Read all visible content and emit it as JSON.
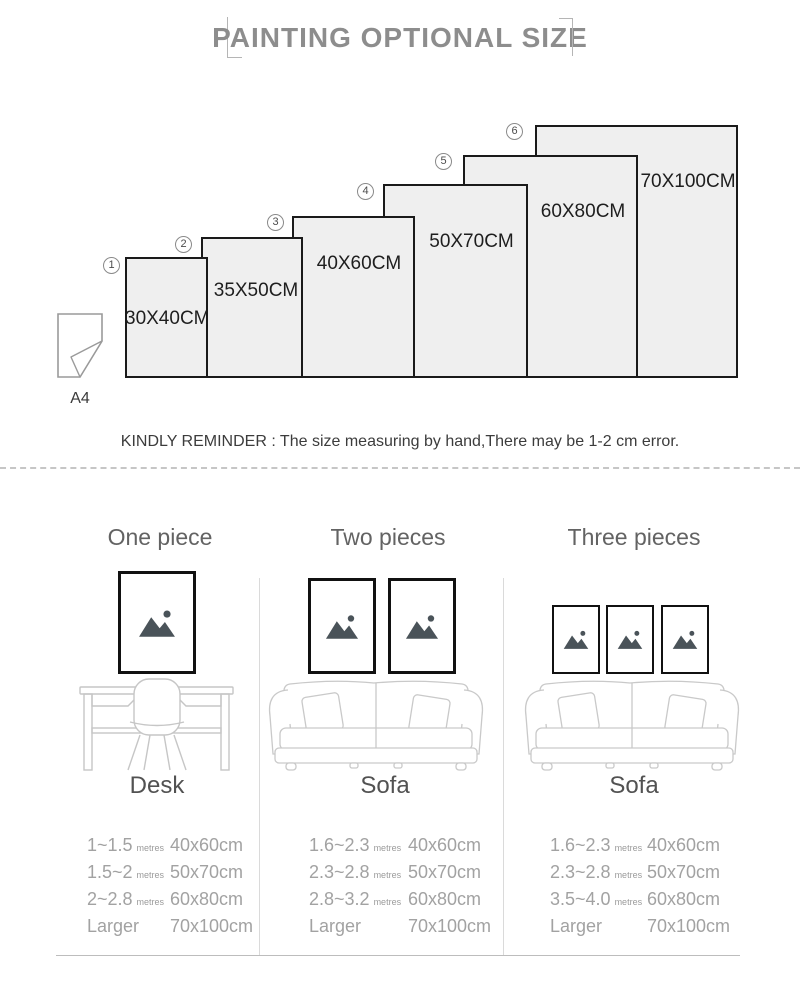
{
  "header": {
    "title": "PAINTING OPTIONAL SIZE"
  },
  "size_chart": {
    "a4_label": "A4",
    "items": [
      {
        "num": "1",
        "label": "30X40CM"
      },
      {
        "num": "2",
        "label": "35X50CM"
      },
      {
        "num": "3",
        "label": "40X60CM"
      },
      {
        "num": "4",
        "label": "50X70CM"
      },
      {
        "num": "5",
        "label": "60X80CM"
      },
      {
        "num": "6",
        "label": "70X100CM"
      }
    ]
  },
  "reminder": "KINDLY REMINDER : The size measuring by hand,There may be 1-2 cm error.",
  "columns": [
    {
      "heading": "One piece",
      "furniture": "Desk",
      "rows": [
        {
          "range": "1~1.5",
          "unit": "metres",
          "size": "40x60cm"
        },
        {
          "range": "1.5~2",
          "unit": "metres",
          "size": "50x70cm"
        },
        {
          "range": "2~2.8",
          "unit": "metres",
          "size": "60x80cm"
        },
        {
          "range": "Larger",
          "unit": "",
          "size": "70x100cm"
        }
      ]
    },
    {
      "heading": "Two pieces",
      "furniture": "Sofa",
      "rows": [
        {
          "range": "1.6~2.3",
          "unit": "metres",
          "size": "40x60cm"
        },
        {
          "range": "2.3~2.8",
          "unit": "metres",
          "size": "50x70cm"
        },
        {
          "range": "2.8~3.2",
          "unit": "metres",
          "size": "60x80cm"
        },
        {
          "range": "Larger",
          "unit": "",
          "size": "70x100cm"
        }
      ]
    },
    {
      "heading": "Three pieces",
      "furniture": "Sofa",
      "rows": [
        {
          "range": "1.6~2.3",
          "unit": "metres",
          "size": "40x60cm"
        },
        {
          "range": "2.3~2.8",
          "unit": "metres",
          "size": "50x70cm"
        },
        {
          "range": "3.5~4.0",
          "unit": "metres",
          "size": "60x80cm"
        },
        {
          "range": "Larger",
          "unit": "",
          "size": "70x100cm"
        }
      ]
    }
  ],
  "colors": {
    "panel_fill": "#efefef",
    "panel_border": "#1a1a1a",
    "muted_text": "#a2a2a2",
    "icon_dark": "#4a5359",
    "line_art": "#c9c9c9"
  }
}
